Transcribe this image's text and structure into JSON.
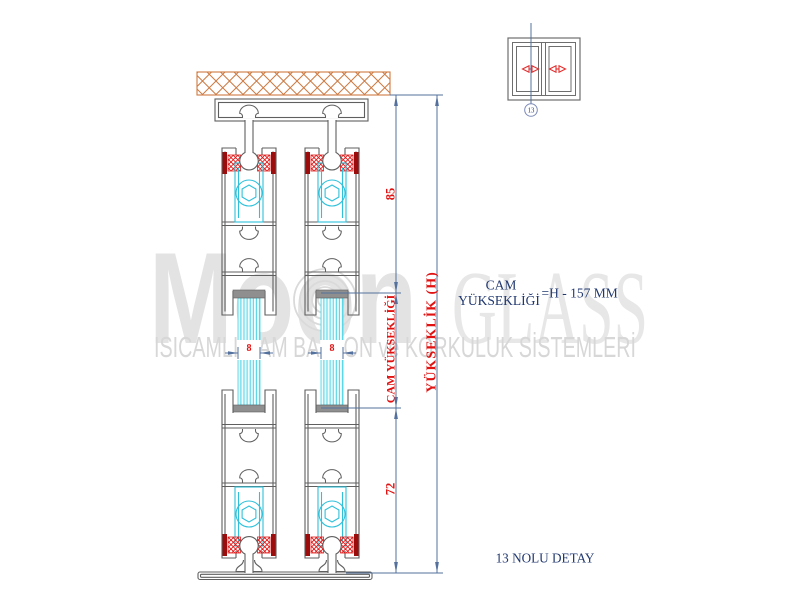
{
  "watermark": {
    "brand_bold": "Moon",
    "brand_serif": "GLASS",
    "tagline": "ISICAMLI CAM BALKON ve KORKULUK SİSTEMLERİ"
  },
  "drawing": {
    "dimensions": {
      "top_segment": "85",
      "glass_segment_label": "CAM YÜKSEKLİĞİ",
      "bottom_segment": "72",
      "overall_label": "YÜKSEKLİK (H)",
      "glass_width_left": "8",
      "glass_width_right": "8"
    },
    "formula": {
      "line1": "CAM",
      "line2": "YÜKSEKLİĞİ",
      "rhs": "=H - 157 MM"
    },
    "detail": {
      "callout_number": "13",
      "caption": "13 NOLU DETAY"
    }
  },
  "colors": {
    "profile_outline": "#5f5f5f",
    "roller_cyan": "#2fc1da",
    "glass_stripe": "#4ad2e4",
    "brush_red": "#e21717",
    "brush_cap_dark_red": "#9b0d0d",
    "dimension_line_blue": "#54719e",
    "dimension_text_red": "#e11212",
    "annotation_navy": "#21386f",
    "hatch_orange": "#cd7a42",
    "watermark_gray": "#e3e3e3"
  }
}
